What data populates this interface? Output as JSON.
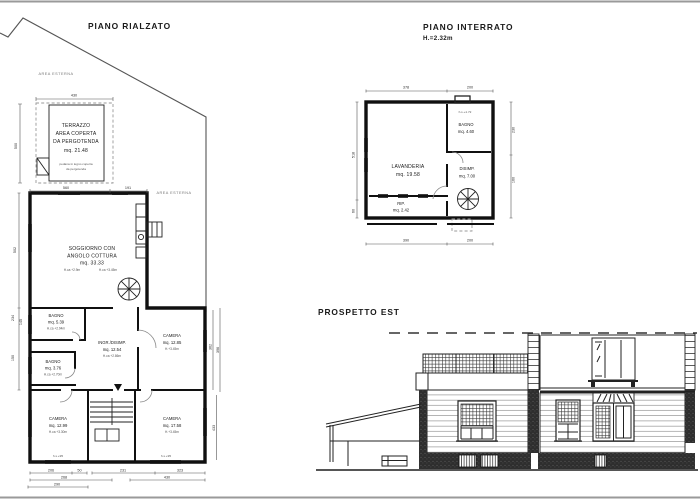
{
  "plan_rialzato": {
    "title": "PIANO RIALZATO",
    "area_esterna_1": "AREA ESTERNA",
    "area_esterna_2": "AREA ESTERNA",
    "terrazzo": {
      "l1": "TERRAZZO",
      "l2": "AREA COPERTA",
      "l3": "DA PERGOTENDA",
      "l4": "mq. 21.48",
      "note1": "pedana in legno coperta",
      "note2": "da pergotenda"
    },
    "soggiorno": {
      "l1": "SOGGIORNO CON",
      "l2": "ANGOLO COTTURA",
      "l3": "mq. 33.33",
      "h1": "H.ca +2.9m",
      "h2": "H.ca +3.45m"
    },
    "bagno1": {
      "l1": "BAGNO",
      "l2": "mq. 5.39",
      "h": "H.ca +2.94m"
    },
    "bagno2": {
      "l1": "BAGNO",
      "l2": "mq. 3.76",
      "h": "H.ca +2.70m"
    },
    "ingresso": {
      "l1": "INGR./DISIMP.",
      "l2": "mq. 12.54",
      "h": "H.ca +2.86m"
    },
    "camera1": {
      "l1": "CAMERA",
      "l2": "mq. 12.85",
      "h": "H.+3.45m"
    },
    "camera2": {
      "l1": "CAMERA",
      "l2": "mq. 12.99",
      "h": "H.ca +3.30m"
    },
    "camera3": {
      "l1": "CAMERA",
      "l2": "mq. 17.58",
      "h": "H.+3.45m"
    },
    "window_label": "h.s.+95",
    "dims": {
      "top": "430",
      "left_terrace": "500",
      "mid1": "560",
      "mid2": "191",
      "b1a": "206",
      "b1b": "50",
      "b1c": "231",
      "b1d": "323",
      "b2a": "268",
      "b2b": "430",
      "b3": "290",
      "l1": "502",
      "l2": "234",
      "l3": "145",
      "l4": "150",
      "r1": "362",
      "r2": "396",
      "r3": "433"
    }
  },
  "plan_interrato": {
    "title": "PIANO INTERRATO",
    "subtitle": "H.=2.32m",
    "lavanderia": {
      "l1": "LAVANDERIA",
      "l2": "mq. 19.58"
    },
    "bagno": {
      "l1": "BAGNO",
      "l2": "mq. 4.60"
    },
    "disimp": {
      "l1": "DISIMP.",
      "l2": "mq. 7.00"
    },
    "rip": {
      "l1": "RIP.",
      "l2": "mq. 2.42"
    },
    "window_label": "h.s.+1.72",
    "dims": {
      "top1": "378",
      "top2": "200",
      "bot1": "390",
      "bot2": "200",
      "left1": "518",
      "left2": "60",
      "right1": "230",
      "right2": "160"
    }
  },
  "prospetto": {
    "title": "PROSPETTO EST"
  },
  "colors": {
    "ink": "#1a1a1a",
    "wall": "#101010",
    "dim": "#555555",
    "dark_fill": "#2e2e2e",
    "paper": "#ffffff",
    "edge": "#9a9a9a"
  }
}
